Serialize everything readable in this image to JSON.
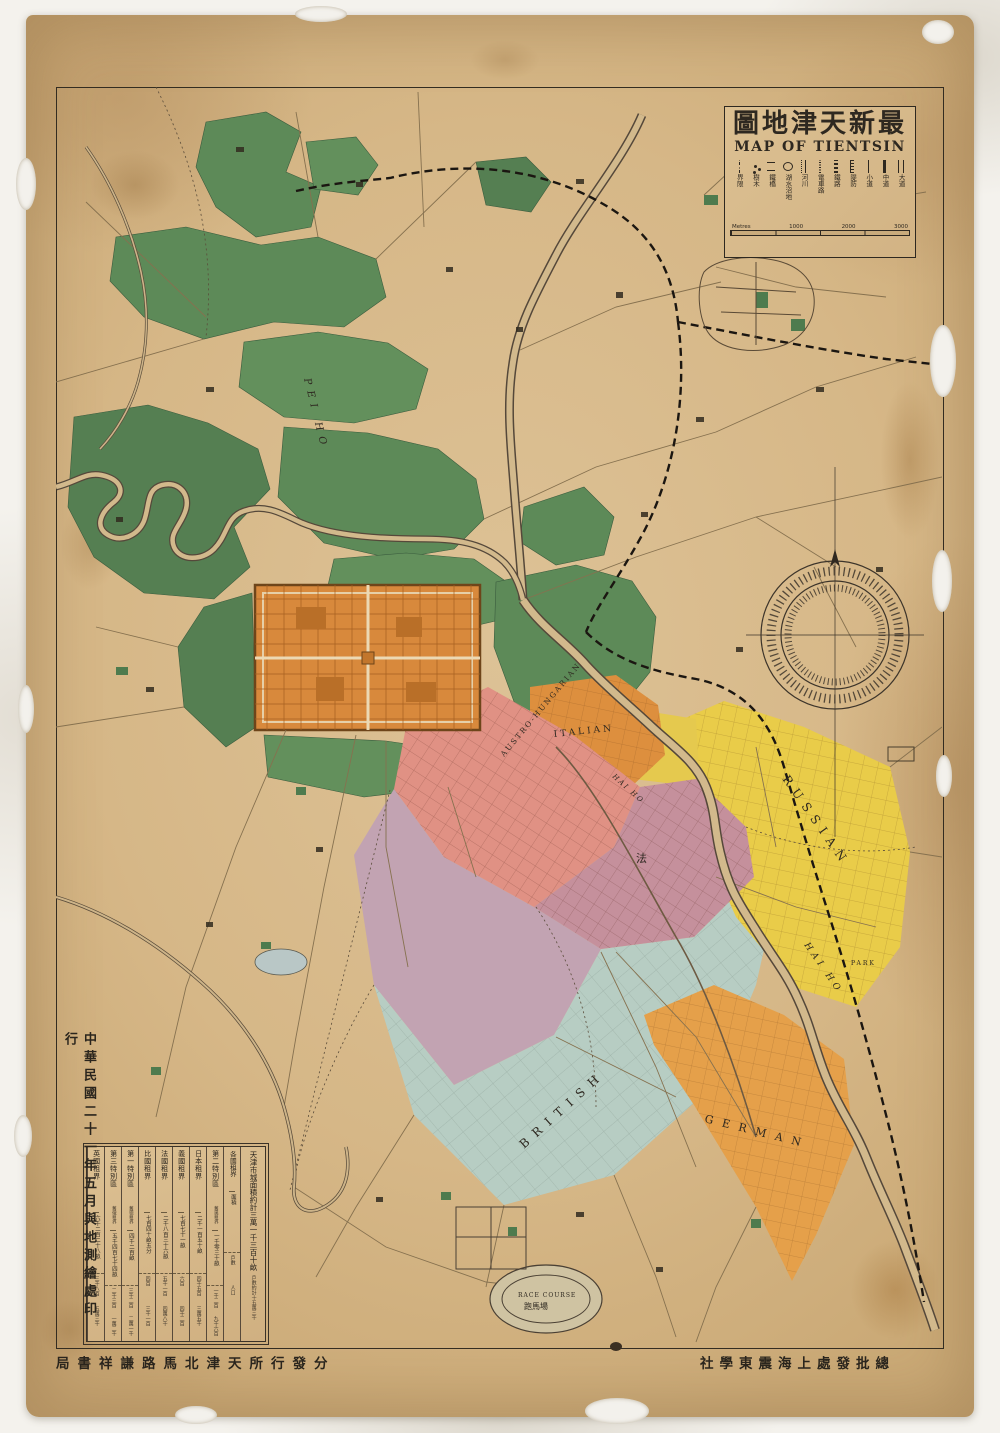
{
  "title": {
    "chinese_reading": "最新天津地圖",
    "chinese_displayed": "圖地津天新最",
    "english": "MAP OF TIENTSIN"
  },
  "legend": {
    "items": [
      {
        "label": "大道",
        "symbol": "double-line"
      },
      {
        "label": "中道",
        "symbol": "thick-line"
      },
      {
        "label": "小道",
        "symbol": "thin-line"
      },
      {
        "label": "隄防",
        "symbol": "hatch-line"
      },
      {
        "label": "鐵路",
        "symbol": "railway-line"
      },
      {
        "label": "電車路",
        "symbol": "dotted-line"
      },
      {
        "label": "河川",
        "symbol": "river-line"
      },
      {
        "label": "湖水沼地",
        "symbol": "lake-blob"
      },
      {
        "label": "鐵橋",
        "symbol": "bridge"
      },
      {
        "label": "樹木",
        "symbol": "trees"
      },
      {
        "label": "界限",
        "symbol": "dash-dot-line"
      }
    ]
  },
  "scale_bar": {
    "left_label": "Metres",
    "ticks": [
      "1000",
      "2000",
      "3000"
    ]
  },
  "map_labels": {
    "pei_ho": "PEI HO",
    "hai_ho": "HAI HO",
    "russian": "RUSSIAN",
    "british": "BRITISH",
    "german": "GERMAN",
    "italian": "ITALIAN",
    "austro_hungarian": "AUSTRO-HUNGARIAN",
    "park": "PARK",
    "race_course": "RACE COURSE",
    "race_course_chinese": "跑馬場",
    "french_chinese": "法"
  },
  "concession_table": {
    "header": {
      "line1": "天津市城面積約計三萬一千三百十畝",
      "line2": "戶數約計十五萬三千",
      "line3": "人口約計一百二十三萬"
    },
    "row_labels": {
      "name": "各國租界",
      "area": "面積",
      "households": "戶數",
      "population": "人口"
    },
    "columns": [
      {
        "name": "第二特別區",
        "subname": "舊奧租界",
        "area": "一千零三十畝",
        "households": "一千二百",
        "population": "九千六百"
      },
      {
        "name": "日本租界",
        "subname": "",
        "area": "二千一百五十畝",
        "households": "四千五百",
        "population": "三萬五千"
      },
      {
        "name": "義國租界",
        "subname": "",
        "area": "七百七十一畝",
        "households": "六百",
        "population": "四千二百"
      },
      {
        "name": "法國租界",
        "subname": "",
        "area": "二千八百三十六畝",
        "households": "五千一百",
        "population": "四萬八千"
      },
      {
        "name": "比國租界",
        "subname": "",
        "area": "七百四十畝五分",
        "households": "四百",
        "population": "三千一百"
      },
      {
        "name": "第一特別區",
        "subname": "舊德租界",
        "area": "四千二百畝",
        "households": "三千二百",
        "population": "二萬一千"
      },
      {
        "name": "第三特別區",
        "subname": "舊俄租界",
        "area": "五千四百七十四畝",
        "households": "二千三百",
        "population": "一萬二千"
      },
      {
        "name": "英國租界",
        "subname": "",
        "area": "六千二百二十八畝",
        "households": "三千八百",
        "population": "五萬三千"
      }
    ]
  },
  "publisher": {
    "date_vertical": "中華民國二十一年五月與地測繪處印行",
    "distributor_reading": "分發行所天津北馬路謙祥書局",
    "distributor_displayed": "局書祥謙路馬北津天所行發分",
    "wholesale_reading": "總批發處上海震東學社",
    "wholesale_displayed": "社學東震海上處發批總"
  },
  "colors": {
    "paper": "#d8ba8c",
    "ink": "#2e2820",
    "green": "#5d8a58",
    "old_city": "#d8893c",
    "japanese": "#e09184",
    "french": "#c5909c",
    "french_extension": "#c2a3b2",
    "british": "#b7cdc3",
    "russian": "#e9cc49",
    "german": "#e5a04a",
    "italian": "#dd8f3e",
    "river": "#d2b98c"
  }
}
